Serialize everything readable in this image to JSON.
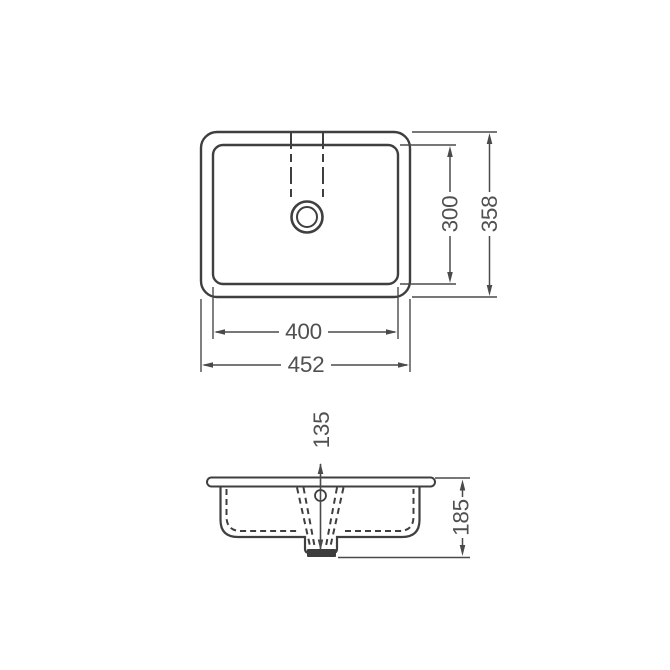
{
  "colors": {
    "line": "#3f3f3f",
    "dim": "#4a4a4a",
    "text": "#505050",
    "background": "#ffffff",
    "drain_fill": "#3d3d3d"
  },
  "plan_view": {
    "inner_width": "400",
    "outer_width": "452",
    "inner_depth": "300",
    "outer_depth": "358"
  },
  "section_view": {
    "bowl_depth": "135",
    "overall_depth": "185"
  }
}
